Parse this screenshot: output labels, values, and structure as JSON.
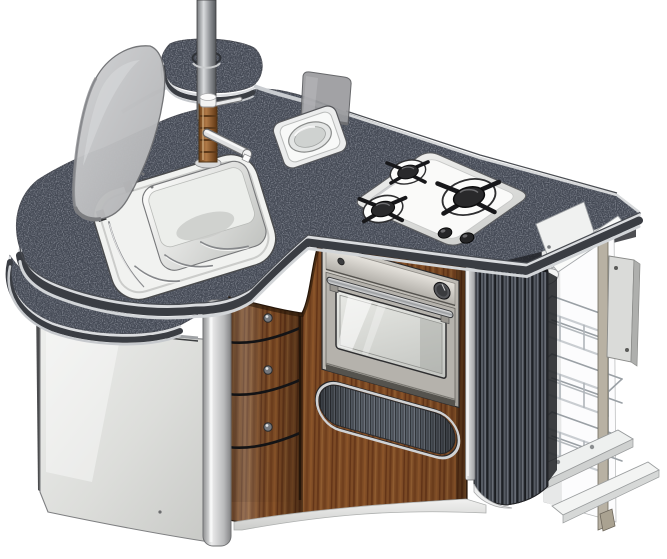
{
  "meta": {
    "background": "#ffffff"
  },
  "scene": {
    "title": "Compact kitchen unit - isometric CAD render",
    "parts": [
      {
        "name": "support-pole"
      },
      {
        "name": "rear-pole-shelf"
      },
      {
        "name": "sink-glass-lid"
      },
      {
        "name": "sink-with-drainer"
      },
      {
        "name": "faucet"
      },
      {
        "name": "round-basin-with-lid"
      },
      {
        "name": "gas-hob",
        "burners": 3,
        "knobs": 2
      },
      {
        "name": "oven",
        "knobs": 1
      },
      {
        "name": "drawer-stack",
        "drawers": 3
      },
      {
        "name": "vent-grille"
      },
      {
        "name": "left-side-panel"
      },
      {
        "name": "lower-shelf"
      },
      {
        "name": "corner-post"
      },
      {
        "name": "tambour-column"
      },
      {
        "name": "pull-out-wire-rack",
        "baskets": 3
      },
      {
        "name": "mounting-plate"
      },
      {
        "name": "base-slide"
      }
    ]
  },
  "colors": {
    "countertop": "#454a55",
    "counter-edge-chrome": "#d2d5d8",
    "counter-edge-shadow": "#3a3d43",
    "sink": "#f1f2f0",
    "steel": "#eceded",
    "chrome": "#d6d8da",
    "glass-lid": "#c3c4c6",
    "smoked-glass": "#9b9c9f",
    "wood": "#7d4b25",
    "burner-black": "#2b2b2d",
    "oven-steel": "#c6c3bd",
    "aluminium": "#c6c7c9",
    "cabinet-white": "#e8e9e7",
    "rack-chrome": "#c9cdd1",
    "rail-tan": "#b8b1a3",
    "outline": "#3f424a",
    "bg": "#ffffff"
  }
}
